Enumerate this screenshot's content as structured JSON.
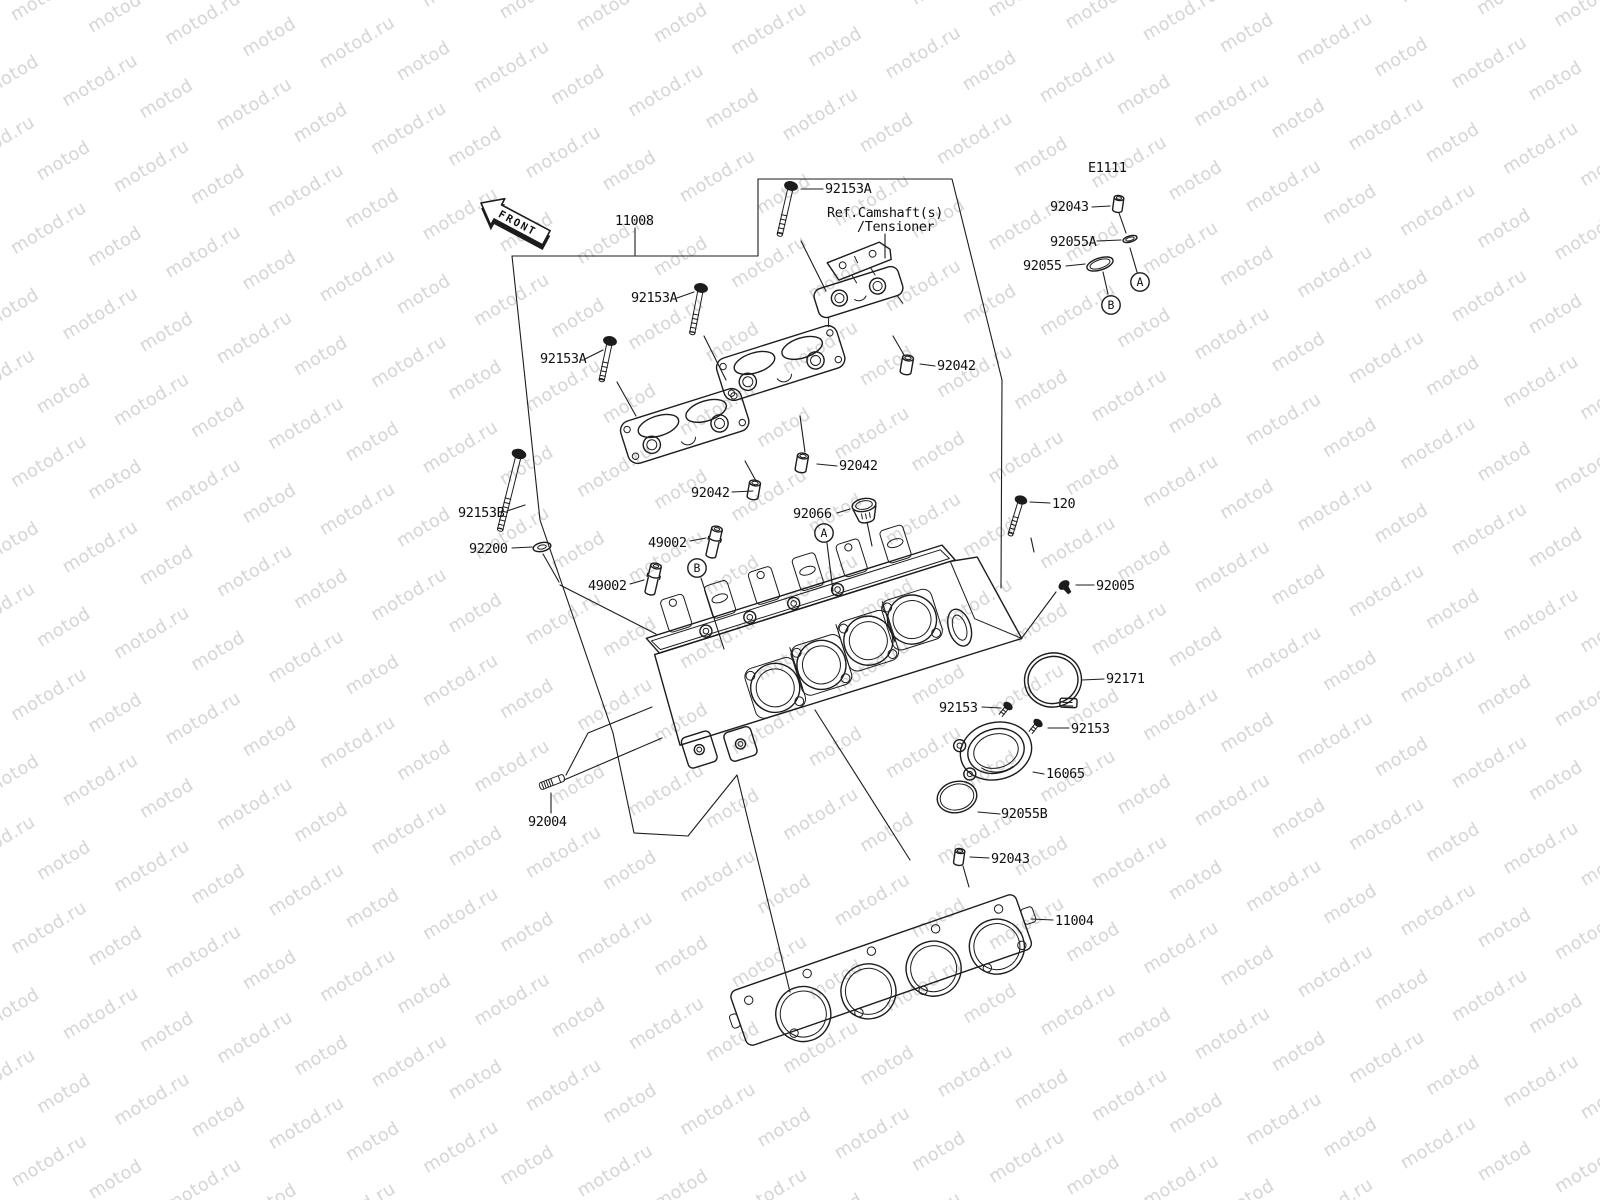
{
  "watermark": {
    "text": "motod.ru",
    "color": "#d4d4d8"
  },
  "diagram": {
    "code": "E1111",
    "front_label": "FRONT",
    "ref_note_line1": "Ref.Camshaft(s)",
    "ref_note_line2": "/Tensioner",
    "marker_a": "A",
    "marker_b": "B",
    "callouts": {
      "bolt_92153A_1": "92153A",
      "bolt_92153A_2": "92153A",
      "bolt_92153A_3": "92153A",
      "head_11008": "11008",
      "pin_92043_top": "92043",
      "oring_92055A": "92055A",
      "oring_92055": "92055",
      "dowel_92042_1": "92042",
      "dowel_92042_2": "92042",
      "dowel_92042_3": "92042",
      "bolt_92153B": "92153B",
      "washer_92200": "92200",
      "guide_49002_1": "49002",
      "guide_49002_2": "49002",
      "cap_92066": "92066",
      "bolt_120": "120",
      "plug_92005": "92005",
      "clamp_92171": "92171",
      "screw_92153_1": "92153",
      "screw_92153_2": "92153",
      "holder_16065": "16065",
      "oring_92055B": "92055B",
      "stud_92004": "92004",
      "pin_92043_bottom": "92043",
      "gasket_11004": "11004"
    }
  }
}
